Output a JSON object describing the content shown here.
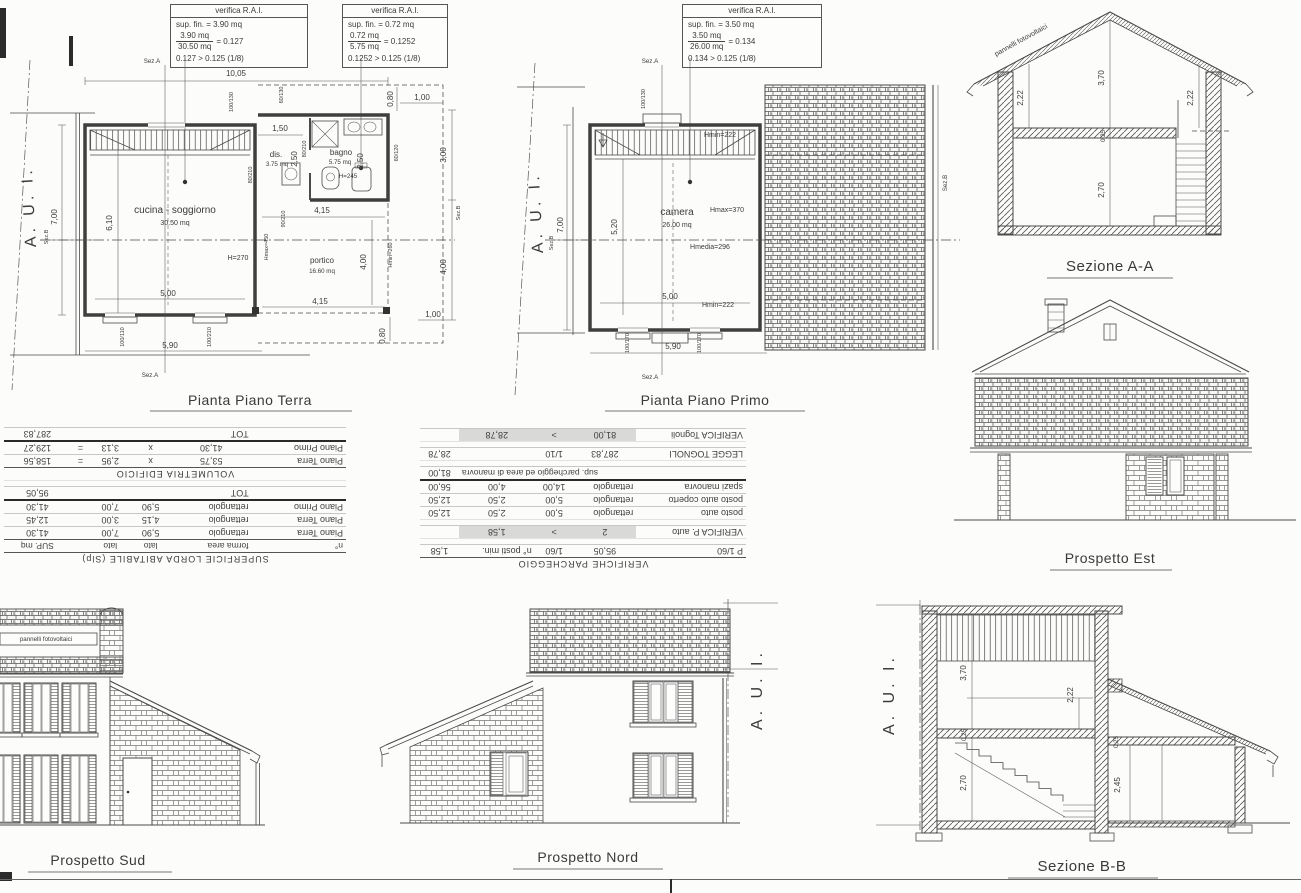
{
  "sheet": {
    "paper": "#fcfcfa",
    "ink": "#3a3a3a",
    "highlight": "#d9d9d8"
  },
  "rai_boxes": [
    {
      "title": "verifica R.A.I.",
      "sup": "sup. fin. = 3.90 mq",
      "num": "3.90 mq",
      "den": "30.50 mq",
      "eq": "= 0.127",
      "check": "0.127 > 0.125 (1/8)"
    },
    {
      "title": "verifica R.A.I.",
      "sup": "sup. fin. = 0.72 mq",
      "num": "0.72 mq",
      "den": "5.75 mq",
      "eq": "= 0.1252",
      "check": "0.1252 > 0.125 (1/8)"
    },
    {
      "title": "verifica R.A.I.",
      "sup": "sup. fin. = 3.50 mq",
      "num": "3.50 mq",
      "den": "26.00 mq",
      "eq": "= 0.134",
      "check": "0.134 > 0.125 (1/8)"
    }
  ],
  "plan_terra": {
    "title": "Pianta Piano Terra",
    "aui": "A. U. I.",
    "rooms": {
      "cucina_name": "cucina - soggiorno",
      "cucina_area": "30.50 mq",
      "cucina_h": "H=270",
      "dis_name": "dis.",
      "dis_area": "3.75 mq",
      "bagno_name": "bagno",
      "bagno_area": "5.75 mq",
      "bagno_h": "H=245",
      "portico_name": "portico",
      "portico_area": "16.60 mq"
    },
    "dims": {
      "top_w": "10,05",
      "sez_a": "Sez.A",
      "sez_b": "Sez.B",
      "left_h": "7,00",
      "room_h": "6,10",
      "room_w": "5,00",
      "bottom_w": "5,90",
      "d150": "1,50",
      "d250": "2,50",
      "d415": "4,15",
      "d400": "4,00",
      "d100": "1,00",
      "d080": "0,80",
      "gap3": "3,00",
      "gap4": "4,00",
      "w100130": "100/130",
      "w60130": "60/130",
      "w80210": "80/210",
      "w90210": "90/210",
      "w60120": "60/120",
      "w100110": "100/110",
      "w100210": "100/210",
      "hmax450": "Hmax=450",
      "hmin260": "Hmin=260"
    }
  },
  "plan_primo": {
    "title": "Pianta Piano Primo",
    "aui": "A. U. I.",
    "rooms": {
      "camera_name": "camera",
      "camera_area": "26.00 mq",
      "hmax": "Hmax=370",
      "hmedia": "Hmedia=296",
      "hmin": "Hmin=222"
    },
    "dims": {
      "sez_a": "Sez.A",
      "sez_b": "Sez.B",
      "left_h": "7,00",
      "room_h": "5,20",
      "room_w": "5,00",
      "bottom_w": "5,90",
      "w100130": "100/130",
      "w100170": "100/170"
    }
  },
  "sezione_aa": {
    "title": "Sezione A-A",
    "pv": "pannelli fotovoltaici",
    "d370": "3,70",
    "d222": "2,22",
    "d025": "0,25",
    "d270": "2,70"
  },
  "prospetto_est": {
    "title": "Prospetto Est"
  },
  "prospetto_sud": {
    "title": "Prospetto Sud",
    "pv": "pannelli fotovoltaici"
  },
  "prospetto_nord": {
    "title": "Prospetto Nord",
    "aui": "A. U. I."
  },
  "sezione_bb": {
    "title": "Sezione B-B",
    "aui": "A. U. I.",
    "d370": "3,70",
    "d222": "2,22",
    "d270": "2,70",
    "d025": "0,25",
    "d245": "2,45"
  },
  "table_slp": {
    "title": "SUPERFICIE LORDA ABITABILE (Slp)",
    "headers": [
      "n°",
      "forma area",
      "lato",
      "lato",
      "SUP. mq"
    ],
    "rows": [
      [
        "Piano Terra",
        "rettangolo",
        "5,90",
        "7,00",
        "41,30"
      ],
      [
        "Piano Terra",
        "rettangolo",
        "4,15",
        "3,00",
        "12,45"
      ],
      [
        "Piano Primo",
        "rettangolo",
        "5,90",
        "7,00",
        "41,30"
      ]
    ],
    "tot_label": "TOT",
    "tot": "95,05",
    "vol_title": "VOLUMETRIA EDIFICIO",
    "vol_rows": [
      [
        "Piano Terra",
        "53,75",
        "x",
        "2,95",
        "=",
        "158,56"
      ],
      [
        "Piano Primo",
        "41,30",
        "x",
        "3,13",
        "=",
        "129,27"
      ]
    ],
    "vol_tot_label": "TOT",
    "vol_tot": "287,83"
  },
  "table_park": {
    "title": "VERIFICHE PARCHEGGIO",
    "row_p60": [
      "P 1/60",
      "95,05",
      "1/60",
      "n° posti min.",
      "1,58"
    ],
    "verif_auto": [
      "VERIFICA P. auto",
      "2",
      ">",
      "1,58"
    ],
    "rows": [
      [
        "posto auto",
        "rettangolo",
        "5,00",
        "2,50",
        "12,50"
      ],
      [
        "posto auto coperto",
        "rettangolo",
        "5,00",
        "2,50",
        "12,50"
      ],
      [
        "spazi manovra",
        "rettangolo",
        "14,00",
        "4,00",
        "56,00"
      ]
    ],
    "sum_label": "sup. parcheggio ed area di manovra",
    "sum": "81,00",
    "tognoli_row": [
      "LEGGE TOGNOLI",
      "287,83",
      "1/10",
      "28,78"
    ],
    "verif_tognoli": [
      "VERIFICA Tognoli",
      "81,00",
      ">",
      "28,78"
    ]
  }
}
